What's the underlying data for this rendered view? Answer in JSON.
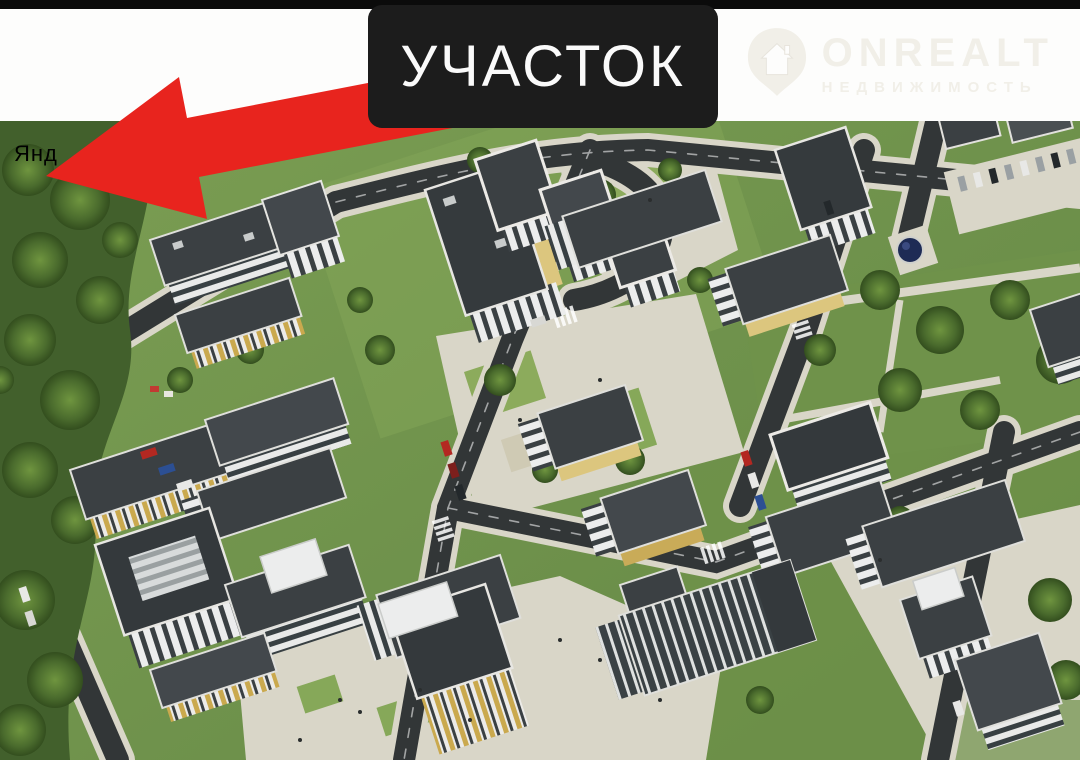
{
  "annotation": {
    "label": "УЧАСТОК",
    "label_bg": "#1c1c1c",
    "label_text_color": "#fafafa",
    "arrow_color": "#e8241e",
    "arrow_direction": "points-lower-left-to-green-plot"
  },
  "watermarks": {
    "brand": {
      "name": "ONREALT",
      "subtitle": "НЕДВИЖИМОСТЬ",
      "icon": "house-location-pin-icon",
      "color": "#f1efe8"
    },
    "map_fragment": "Янд"
  },
  "scene": {
    "type": "aerial-3d-render-residential-complex",
    "colors": {
      "grass": "#76994e",
      "forest": "#42602c",
      "road": "#323637",
      "sidewalk": "#d9d6c8",
      "roof": "#3b4043",
      "facade": "#eceded",
      "accent_yellow": "#dcc67e",
      "water_tower_dome": "#1e2b55",
      "top_strip": "#0b0b0b",
      "header_band": "#fdfdfc"
    }
  }
}
